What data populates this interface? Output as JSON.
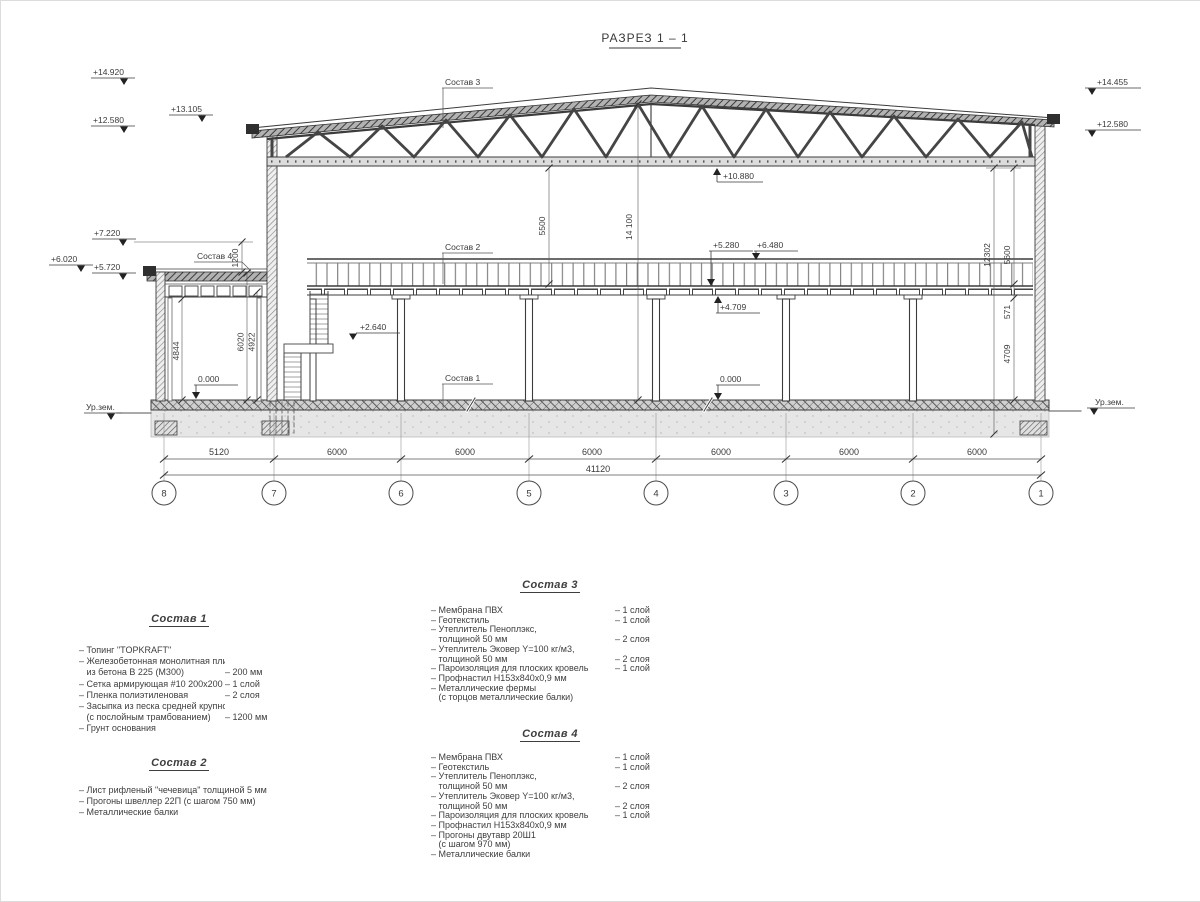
{
  "title": "РАЗРЕЗ 1 – 1",
  "levels": {
    "ridge_left": "+14.920",
    "eave_left": "+13.105",
    "truss_left": "+12.580",
    "annex_top": "+7.220",
    "annex_roof": "+6.020",
    "annex_roof_bottom": "+5.720",
    "ridge_right": "+14.455",
    "truss_right": "+12.580",
    "truss_bottom": "+10.880",
    "mezz_deck": "+5.280",
    "rail_top": "+6.480",
    "beam_bottom": "+4.709",
    "floor_main": "0.000",
    "floor_annex": "0.000",
    "landing": "+2.640",
    "ground_left": "Ур.зем.",
    "ground_right": "Ур.зем."
  },
  "dims": {
    "v5500": "5500",
    "v14100": "14 100",
    "v1200": "1200",
    "v4844": "4844",
    "v6020": "6020",
    "v4922": "4922",
    "v12302": "12302",
    "v5600": "5600",
    "v571": "571",
    "v4709": "4709"
  },
  "callouts": {
    "c1": "Состав 1",
    "c2": "Состав 2",
    "c3": "Состав 3",
    "c4": "Состав 4"
  },
  "grid": {
    "spans": [
      "5120",
      "6000",
      "6000",
      "6000",
      "6000",
      "6000",
      "6000"
    ],
    "total": "41120",
    "bubbles": [
      "8",
      "7",
      "6",
      "5",
      "4",
      "3",
      "2",
      "1"
    ]
  },
  "specs": {
    "s1": {
      "heading": "Состав 1",
      "items": [
        {
          "t": "– Топинг \"TOPKRAFT\"",
          "v": ""
        },
        {
          "t": "– Железобетонная  монолитная плита",
          "v": ""
        },
        {
          "t": "   из бетона В 225 (М300)",
          "v": "– 200 мм"
        },
        {
          "t": "– Сетка армирующая #10 200х200 мм",
          "v": "– 1 слой"
        },
        {
          "t": "– Пленка полиэтиленовая",
          "v": "– 2 слоя"
        },
        {
          "t": "– Засыпка из песка средней крупности",
          "v": ""
        },
        {
          "t": "   (с послойным трамбованием)",
          "v": "– 1200 мм"
        },
        {
          "t": "– Грунт основания",
          "v": ""
        }
      ]
    },
    "s2": {
      "heading": "Состав 2",
      "items": [
        {
          "t": "– Лист рифленый \"чечевица\" толщиной 5 мм",
          "v": ""
        },
        {
          "t": "– Прогоны швеллер 22П (с шагом 750 мм)",
          "v": ""
        },
        {
          "t": "– Металлические балки",
          "v": ""
        }
      ]
    },
    "s3": {
      "heading": "Состав 3",
      "items": [
        {
          "t": "– Мембрана ПВХ",
          "v": "– 1 слой"
        },
        {
          "t": "– Геотекстиль",
          "v": "– 1 слой"
        },
        {
          "t": "– Утеплитель Пеноплэкс,",
          "v": ""
        },
        {
          "t": "   толщиной 50 мм",
          "v": "– 2 слоя"
        },
        {
          "t": "– Утеплитель Эковер Y=100 кг/м3,",
          "v": ""
        },
        {
          "t": "   толщиной 50 мм",
          "v": "– 2 слоя"
        },
        {
          "t": "– Пароизоляция для плоских кровель",
          "v": "– 1 слой"
        },
        {
          "t": "– Профнастил Н153х840х0,9 мм",
          "v": ""
        },
        {
          "t": "– Металлические фермы",
          "v": ""
        },
        {
          "t": "   (с торцов металлические балки)",
          "v": ""
        }
      ]
    },
    "s4": {
      "heading": "Состав 4",
      "items": [
        {
          "t": "– Мембрана ПВХ",
          "v": "– 1 слой"
        },
        {
          "t": "– Геотекстиль",
          "v": "– 1 слой"
        },
        {
          "t": "– Утеплитель Пеноплэкс,",
          "v": ""
        },
        {
          "t": "   толщиной 50 мм",
          "v": "– 2 слоя"
        },
        {
          "t": "– Утеплитель Эковер Y=100 кг/м3,",
          "v": ""
        },
        {
          "t": "   толщиной 50 мм",
          "v": "– 2 слоя"
        },
        {
          "t": "– Пароизоляция для плоских кровель",
          "v": "– 1 слой"
        },
        {
          "t": "– Профнастил Н153х840х0,9 мм",
          "v": ""
        },
        {
          "t": "– Прогоны двутавр 20Ш1",
          "v": ""
        },
        {
          "t": "   (с шагом 970 мм)",
          "v": ""
        },
        {
          "t": "– Металлические балки",
          "v": ""
        }
      ]
    }
  }
}
